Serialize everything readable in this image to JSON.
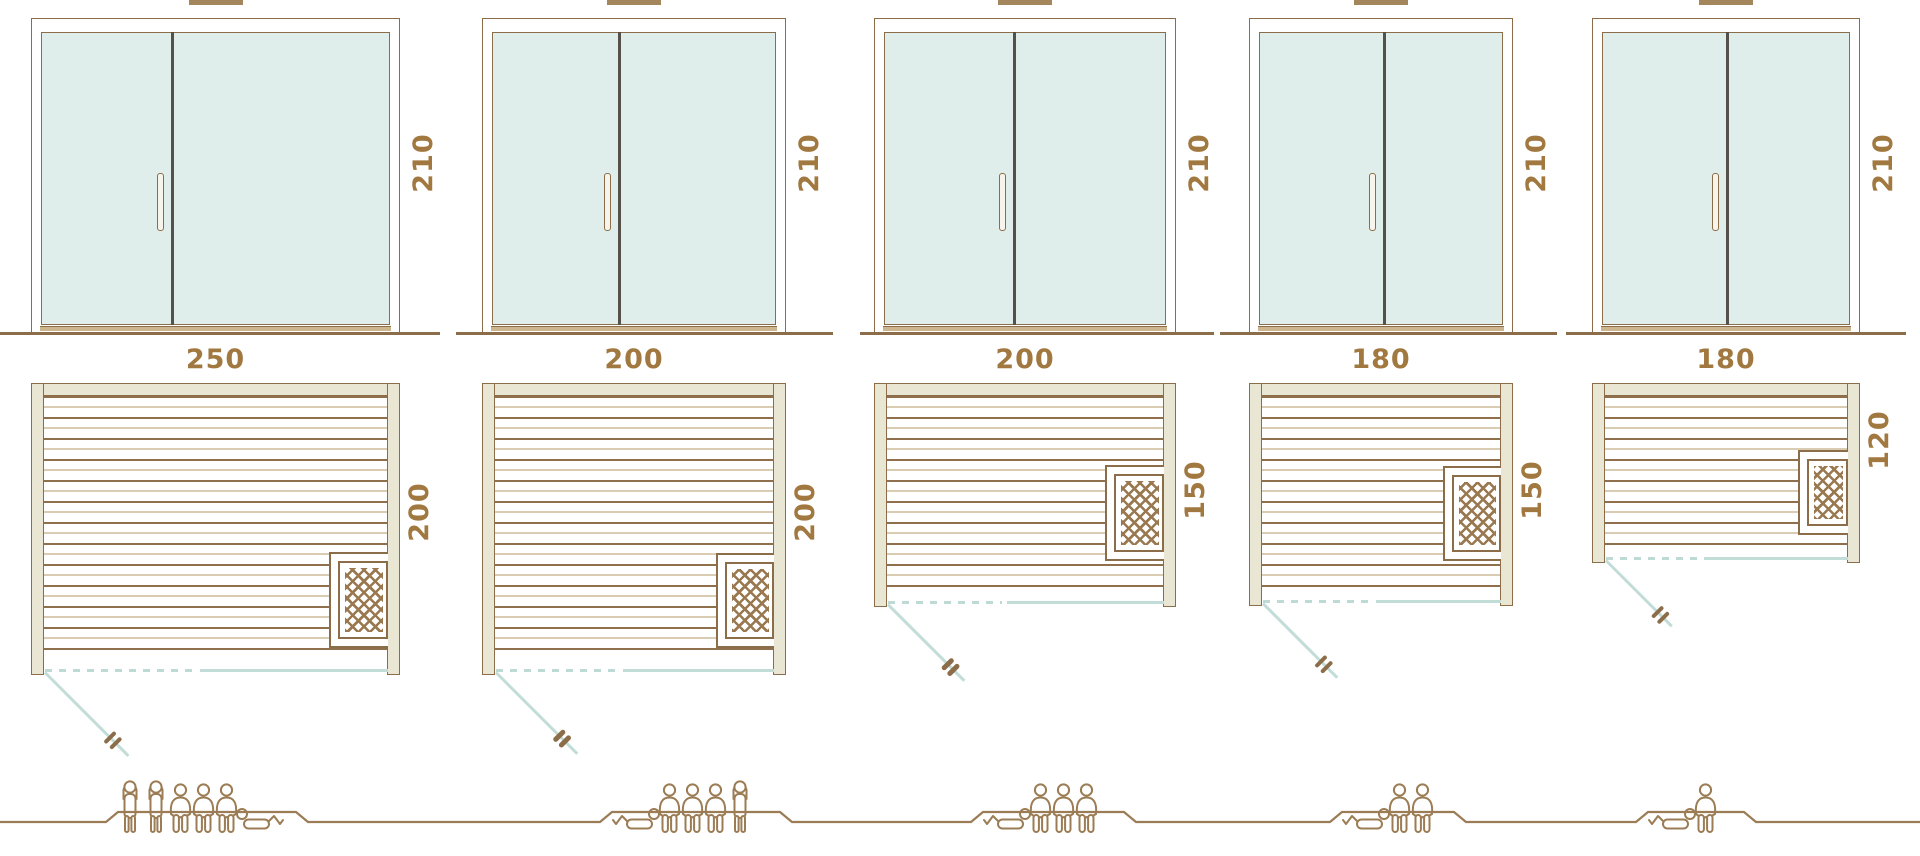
{
  "title": "Sauna size comparison diagram",
  "colors": {
    "outline_brown": "#8c6d49",
    "light_plank": "#d9ccb3",
    "frame_cream": "#e9e6d3",
    "glass_teal": "#e0eeeb",
    "door_swing_teal": "#c2ddd8",
    "label_brown": "#a1783f",
    "people_brown": "#9b7c54"
  },
  "units": [
    {
      "id": "sauna-250x200",
      "door": {
        "height_label": "210",
        "height_cm": 210
      },
      "plan": {
        "width_label": "250",
        "depth_label": "200",
        "width_cm": 250,
        "depth_cm": 200
      },
      "capacity": {
        "total": 6,
        "standing": 2,
        "sitting": 3,
        "lying": 1,
        "figures": [
          "standing",
          "standing",
          "sitting",
          "sitting",
          "sitting",
          "lying-flip"
        ]
      }
    },
    {
      "id": "sauna-200x200",
      "door": {
        "height_label": "210",
        "height_cm": 210
      },
      "plan": {
        "width_label": "200",
        "depth_label": "200",
        "width_cm": 200,
        "depth_cm": 200
      },
      "capacity": {
        "total": 5,
        "standing": 1,
        "sitting": 3,
        "lying": 1,
        "figures": [
          "lying",
          "sitting",
          "sitting",
          "sitting",
          "standing"
        ]
      }
    },
    {
      "id": "sauna-200x150",
      "door": {
        "height_label": "210",
        "height_cm": 210
      },
      "plan": {
        "width_label": "200",
        "depth_label": "150",
        "width_cm": 200,
        "depth_cm": 150
      },
      "capacity": {
        "total": 4,
        "standing": 0,
        "sitting": 3,
        "lying": 1,
        "figures": [
          "lying",
          "sitting",
          "sitting",
          "sitting"
        ]
      }
    },
    {
      "id": "sauna-180x150",
      "door": {
        "height_label": "210",
        "height_cm": 210
      },
      "plan": {
        "width_label": "180",
        "depth_label": "150",
        "width_cm": 180,
        "depth_cm": 150
      },
      "capacity": {
        "total": 3,
        "standing": 0,
        "sitting": 2,
        "lying": 1,
        "figures": [
          "lying",
          "sitting",
          "sitting"
        ]
      }
    },
    {
      "id": "sauna-180x120",
      "door": {
        "height_label": "210",
        "height_cm": 210
      },
      "plan": {
        "width_label": "180",
        "depth_label": "120",
        "width_cm": 180,
        "depth_cm": 120
      },
      "capacity": {
        "total": 2,
        "standing": 0,
        "sitting": 1,
        "lying": 1,
        "figures": [
          "lying",
          "sitting"
        ]
      }
    }
  ]
}
